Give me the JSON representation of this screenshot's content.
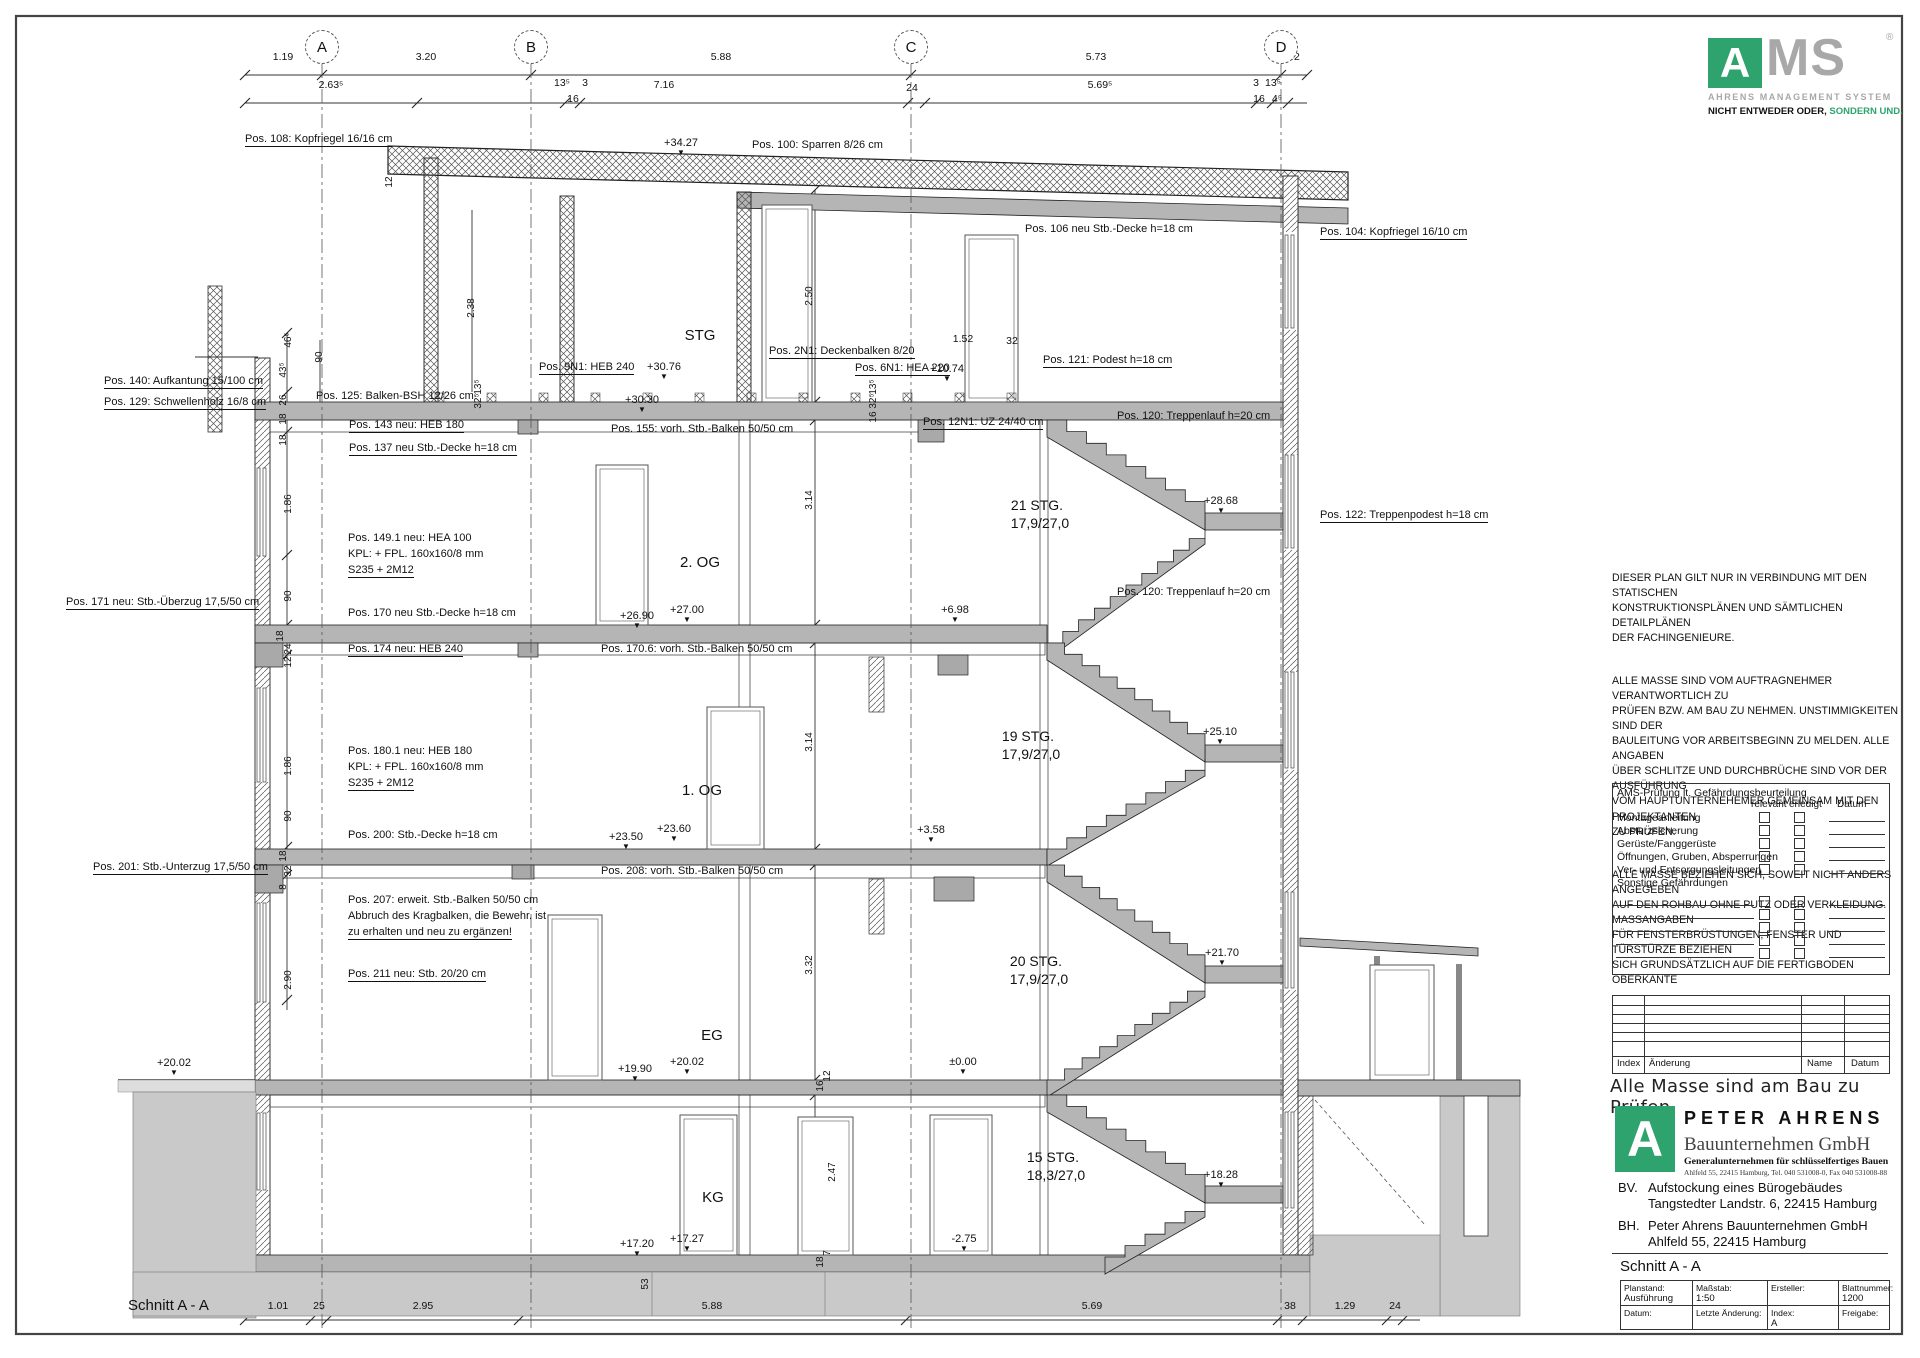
{
  "ams_logo": {
    "a": "A",
    "ms": "MS",
    "reg": "®",
    "line1": "AHRENS MANAGEMENT SYSTEM",
    "tag_black": "NICHT ENTWEDER ODER,",
    "tag_green": "SONDERN UND.",
    "green": "#2fa36e",
    "gray": "#a8a8a8"
  },
  "notes": {
    "p1": "DIESER PLAN GILT NUR IN VERBINDUNG MIT DEN STATISCHEN\nKONSTRUKTIONSPLÄNEN  UND SÄMTLICHEN DETAILPLÄNEN\nDER FACHINGENIEURE.",
    "p2": "ALLE MASSE SIND VOM AUFTRAGNEHMER VERANTWORTLICH ZU\nPRÜFEN BZW. AM BAU ZU NEHMEN. UNSTIMMIGKEITEN SIND DER\nBAULEITUNG  VOR ARBEITSBEGINN ZU MELDEN. ALLE ANGABEN\nÜBER SCHLITZE UND DURCHBRÜCHE SIND VOR DER AUSFÜHRUNG\nVOM HAUPTUNTERNEHEMER GEMEINSAM MIT DEN PROJEKTANTEN\nZU PRÜFEN.",
    "p3": "ALLE MASSE BEZIEHEN SICH, SOWEIT NICHT ANDERS ANGEGEBEN\nAUF DEN ROHBAU OHNE PUTZ ODER VERKLEIDUNG. MASSANGABEN\nFÜR FENSTERBRÜSTUNGEN; FENSTER UND TÜRSTÜRZE BEZIEHEN\nSICH GRUNDSÄTZLICH AUF DIE FERTIGBODEN OBERKANTE"
  },
  "checklist": {
    "title": "AMS-Prüfung lt. Gefährdungsbeurteilung",
    "col_relevant": "relevant",
    "col_erledigt": "erledigt",
    "col_datum": "Datum",
    "items": [
      "Montageanleitung",
      "Absturzsicherung",
      "Gerüste/Fanggerüste",
      "Öffnungen, Gruben, Absperrungen",
      "Ver- und Entsorgungsleitungen",
      "Sonstige Gefährdungen"
    ],
    "blank_rows": 5
  },
  "revision_table": {
    "headers": [
      "Index",
      "Änderung",
      "Name",
      "Datum"
    ],
    "blank_rows": 5
  },
  "mass_note": "Alle Masse sind am Bau zu Prüfen",
  "pa_logo": {
    "a": "A",
    "name": "PETER AHRENS",
    "sub1": "Bauunternehmen GmbH",
    "sub2": "Generalunternehmen für schlüsselfertiges Bauen",
    "addr": "Ahlfeld 55, 22415 Hamburg, Tel. 040 531008-0, Fax 040 531008-88"
  },
  "project": {
    "bv_label": "BV.",
    "bv_line1": "Aufstockung eines Bürogebäudes",
    "bv_line2": "Tangstedter Landstr. 6, 22415 Hamburg",
    "bh_label": "BH.",
    "bh_line1": "Peter Ahrens Bauunternehmen GmbH",
    "bh_line2": "Ahlfeld 55, 22415 Hamburg"
  },
  "sheet": {
    "title_panel": "Schnitt A - A"
  },
  "title_block": {
    "cells": [
      {
        "label": "Planstand:",
        "value": "Ausführung"
      },
      {
        "label": "Maßstab:",
        "value": "1:50"
      },
      {
        "label": "Ersteller:",
        "value": ""
      },
      {
        "label": "Blattnummer:",
        "value": "1200"
      },
      {
        "label": "Datum:",
        "value": ""
      },
      {
        "label": "Letzte Änderung:",
        "value": ""
      },
      {
        "label": "Index:",
        "value": "A"
      },
      {
        "label": "Freigabe:",
        "value": ""
      }
    ]
  },
  "drawing": {
    "level_marker": "▼",
    "axes": [
      {
        "label": "A",
        "x": 322
      },
      {
        "label": "B",
        "x": 531
      },
      {
        "label": "C",
        "x": 911
      },
      {
        "label": "D",
        "x": 1281
      }
    ],
    "labels": [
      [
        283,
        52,
        "1.19",
        "d"
      ],
      [
        426,
        52,
        "3.20",
        "d"
      ],
      [
        721,
        52,
        "5.88",
        "d"
      ],
      [
        1096,
        52,
        "5.73",
        "d"
      ],
      [
        1294,
        52,
        "42",
        "d"
      ],
      [
        331,
        80,
        "2.63⁵",
        "d"
      ],
      [
        562,
        78,
        "13⁵",
        "d"
      ],
      [
        585,
        78,
        "3",
        "d"
      ],
      [
        664,
        80,
        "7.16",
        "d"
      ],
      [
        912,
        83,
        "24",
        "d"
      ],
      [
        1100,
        80,
        "5.69⁵",
        "d"
      ],
      [
        1256,
        78,
        "3",
        "d"
      ],
      [
        1273,
        78,
        "13⁵",
        "d"
      ],
      [
        573,
        94,
        "16",
        "d"
      ],
      [
        1259,
        94,
        "16",
        "d"
      ],
      [
        1277,
        94,
        "4⁵",
        "d"
      ],
      [
        278,
        1301,
        "1.01",
        "d"
      ],
      [
        319,
        1301,
        "25",
        "d"
      ],
      [
        423,
        1301,
        "2.95",
        "d"
      ],
      [
        712,
        1301,
        "5.88",
        "d"
      ],
      [
        1092,
        1301,
        "5.69",
        "d"
      ],
      [
        1290,
        1301,
        "38",
        "d"
      ],
      [
        1345,
        1301,
        "1.29",
        "d"
      ],
      [
        1395,
        1301,
        "24",
        "d"
      ],
      [
        128,
        1298,
        "Schnitt A - A",
        "big"
      ],
      [
        963,
        334,
        "1.52",
        "d"
      ],
      [
        1012,
        336,
        "32",
        "d"
      ],
      [
        245,
        134,
        "Pos. 108: Kopfriegel 16/16 cm",
        "pu"
      ],
      [
        752,
        140,
        "Pos. 100: Sparren 8/26 cm",
        "p"
      ],
      [
        1025,
        224,
        "Pos. 106 neu Stb.-Decke h=18 cm",
        "p"
      ],
      [
        1320,
        227,
        "Pos. 104: Kopfriegel 16/10 cm",
        "pu"
      ],
      [
        539,
        362,
        "Pos. 9N1: HEB 240",
        "pu"
      ],
      [
        769,
        346,
        "Pos. 2N1: Deckenbalken 8/20",
        "pu"
      ],
      [
        855,
        363,
        "Pos. 6N1: HEA 220",
        "pu"
      ],
      [
        1043,
        355,
        "Pos. 121: Podest h=18 cm",
        "pu"
      ],
      [
        104,
        376,
        "Pos. 140: Aufkantung 15/100 cm",
        "pu"
      ],
      [
        316,
        391,
        "Pos. 125: Balken-BSH 12/26 cm",
        "p"
      ],
      [
        104,
        397,
        "Pos. 129: Schwellenholz 16/8 cm",
        "pu"
      ],
      [
        923,
        417,
        "Pos. 12N1: UZ 24/40 cm",
        "pu"
      ],
      [
        1117,
        411,
        "Pos. 120: Treppenlauf h=20 cm",
        "p"
      ],
      [
        349,
        420,
        "Pos. 143 neu: HEB 180",
        "pu"
      ],
      [
        611,
        424,
        "Pos. 155: vorh. Stb.-Balken 50/50 cm",
        "p"
      ],
      [
        349,
        443,
        "Pos. 137 neu Stb.-Decke h=18 cm",
        "pu"
      ],
      [
        1320,
        510,
        "Pos. 122: Treppenpodest h=18 cm",
        "pu"
      ],
      [
        348,
        533,
        "Pos. 149.1 neu: HEA 100",
        "p"
      ],
      [
        348,
        549,
        "KPL: + FPL. 160x160/8 mm",
        "p"
      ],
      [
        348,
        565,
        "S235 + 2M12",
        "pu"
      ],
      [
        1117,
        587,
        "Pos. 120: Treppenlauf h=20 cm",
        "p"
      ],
      [
        66,
        597,
        "Pos. 171 neu: Stb.-Überzug 17,5/50 cm",
        "pu"
      ],
      [
        348,
        608,
        "Pos. 170 neu Stb.-Decke h=18 cm",
        "p"
      ],
      [
        348,
        644,
        "Pos. 174 neu: HEB 240",
        "pu"
      ],
      [
        601,
        644,
        "Pos. 170.6: vorh. Stb.-Balken 50/50 cm",
        "p"
      ],
      [
        348,
        746,
        "Pos. 180.1 neu: HEB 180",
        "p"
      ],
      [
        348,
        762,
        "KPL: + FPL. 160x160/8 mm",
        "p"
      ],
      [
        348,
        778,
        "S235 + 2M12",
        "pu"
      ],
      [
        348,
        830,
        "Pos. 200: Stb.-Decke h=18 cm",
        "p"
      ],
      [
        93,
        862,
        "Pos. 201: Stb.-Unterzug 17,5/50 cm",
        "pu"
      ],
      [
        601,
        866,
        "Pos. 208: vorh. Stb.-Balken 50/50 cm",
        "p"
      ],
      [
        348,
        895,
        "Pos. 207: erweit. Stb.-Balken 50/50 cm",
        "p"
      ],
      [
        348,
        911,
        "Abbruch des Kragbalken, die Bewehr. ist",
        "p"
      ],
      [
        348,
        927,
        "zu erhalten und neu zu ergänzen!",
        "pu"
      ],
      [
        348,
        969,
        "Pos. 211 neu: Stb. 20/20 cm",
        "pu"
      ],
      [
        681,
        138,
        "+34.27",
        "l"
      ],
      [
        664,
        362,
        "+30.76",
        "l"
      ],
      [
        642,
        395,
        "+30.30",
        "l"
      ],
      [
        947,
        364,
        "+10.74",
        "l"
      ],
      [
        1221,
        496,
        "+28.68",
        "l"
      ],
      [
        687,
        605,
        "+27.00",
        "l"
      ],
      [
        637,
        611,
        "+26.90",
        "l"
      ],
      [
        955,
        605,
        "+6.98",
        "l"
      ],
      [
        1220,
        727,
        "+25.10",
        "l"
      ],
      [
        674,
        824,
        "+23.60",
        "l"
      ],
      [
        626,
        832,
        "+23.50",
        "l"
      ],
      [
        931,
        825,
        "+3.58",
        "l"
      ],
      [
        1222,
        948,
        "+21.70",
        "l"
      ],
      [
        687,
        1057,
        "+20.02",
        "l"
      ],
      [
        635,
        1064,
        "+19.90",
        "l"
      ],
      [
        963,
        1057,
        "±0.00",
        "l"
      ],
      [
        1221,
        1170,
        "+18.28",
        "l"
      ],
      [
        687,
        1234,
        "+17.27",
        "l"
      ],
      [
        637,
        1239,
        "+17.20",
        "l"
      ],
      [
        964,
        1234,
        "-2.75",
        "l"
      ],
      [
        174,
        1058,
        "+20.02",
        "l"
      ],
      [
        700,
        328,
        "STG",
        "r"
      ],
      [
        700,
        555,
        "2. OG",
        "r"
      ],
      [
        702,
        783,
        "1. OG",
        "r"
      ],
      [
        712,
        1028,
        "EG",
        "r"
      ],
      [
        713,
        1190,
        "KG",
        "r"
      ],
      [
        1037,
        498,
        "21 STG.",
        "s"
      ],
      [
        1040,
        516,
        "17,9/27,0",
        "s"
      ],
      [
        1028,
        729,
        "19 STG.",
        "s"
      ],
      [
        1031,
        747,
        "17,9/27,0",
        "s"
      ],
      [
        1036,
        954,
        "20 STG.",
        "s"
      ],
      [
        1039,
        972,
        "17,9/27,0",
        "s"
      ],
      [
        1053,
        1150,
        "15 STG.",
        "s"
      ],
      [
        1056,
        1168,
        "18,3/27,0",
        "s"
      ],
      [
        390,
        182,
        "12",
        "v"
      ],
      [
        472,
        308,
        "2.38",
        "v"
      ],
      [
        289,
        340,
        "46⁵",
        "v"
      ],
      [
        320,
        357,
        "90",
        "v"
      ],
      [
        284,
        370,
        "43⁵",
        "v"
      ],
      [
        284,
        400,
        "26",
        "v"
      ],
      [
        284,
        419,
        "18",
        "v"
      ],
      [
        284,
        440,
        "18",
        "v"
      ],
      [
        479,
        387,
        "13⁵",
        "v"
      ],
      [
        479,
        401,
        "32⁵",
        "v"
      ],
      [
        810,
        296,
        "2.50",
        "v"
      ],
      [
        874,
        387,
        "13⁵",
        "v"
      ],
      [
        874,
        401,
        "32⁵",
        "v"
      ],
      [
        874,
        417,
        "16",
        "v"
      ],
      [
        289,
        504,
        "1.86",
        "v"
      ],
      [
        289,
        596,
        "90",
        "v"
      ],
      [
        810,
        500,
        "3.14",
        "v"
      ],
      [
        281,
        636,
        "18",
        "v"
      ],
      [
        289,
        649,
        "24",
        "v"
      ],
      [
        289,
        662,
        "12",
        "v"
      ],
      [
        289,
        766,
        "1.86",
        "v"
      ],
      [
        289,
        816,
        "90",
        "v"
      ],
      [
        810,
        742,
        "3.14",
        "v"
      ],
      [
        284,
        856,
        "18",
        "v"
      ],
      [
        289,
        871,
        "32",
        "v"
      ],
      [
        284,
        887,
        "8",
        "v"
      ],
      [
        289,
        980,
        "2.90",
        "v"
      ],
      [
        810,
        965,
        "3.32",
        "v"
      ],
      [
        821,
        1086,
        "16",
        "v"
      ],
      [
        828,
        1076,
        "12",
        "v"
      ],
      [
        833,
        1172,
        "2.47",
        "v"
      ],
      [
        821,
        1262,
        "18",
        "v"
      ],
      [
        828,
        1253,
        "7",
        "v"
      ],
      [
        646,
        1284,
        "53",
        "v"
      ]
    ]
  }
}
